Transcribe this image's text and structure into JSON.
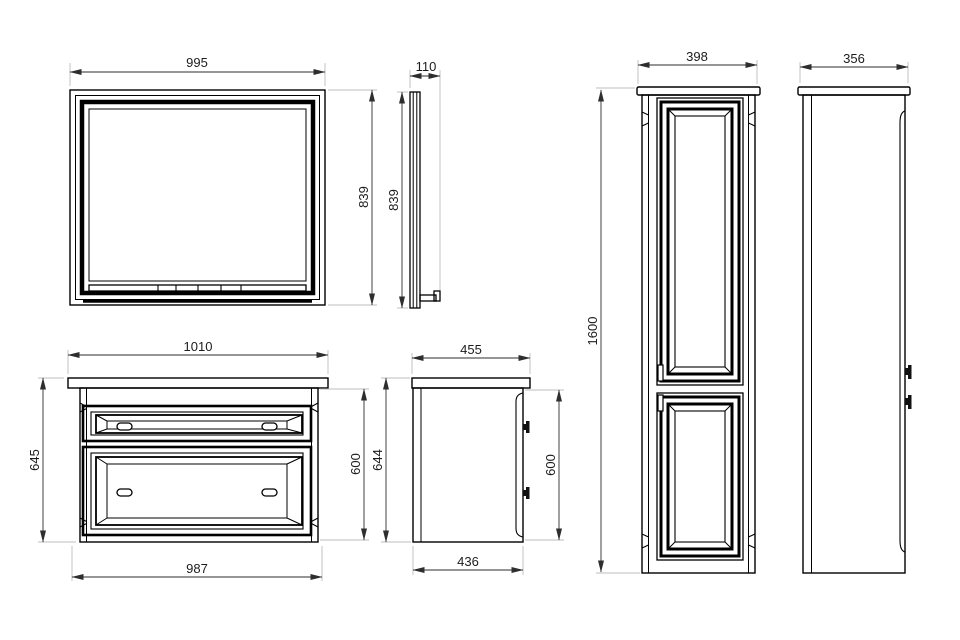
{
  "figure": {
    "type": "technical-drawing",
    "subject": "Bathroom furniture set dimension drawing: mirror (front and side view), vanity unit with two drawers (front and side view), tall cabinet with two doors (front and side view)"
  },
  "colors": {
    "background": "#ffffff",
    "outline": "#000000",
    "dimension_line": "#2e2e2e",
    "extension_line": "#bdbdbd",
    "text": "#1c1c1c"
  },
  "views": {
    "mirror_front": {
      "width": "995",
      "height": "839"
    },
    "mirror_side": {
      "depth": "110",
      "height": "839"
    },
    "vanity_front": {
      "top_width": "1010",
      "overall_height": "645",
      "carcass_height": "600",
      "bottom_width": "987"
    },
    "vanity_side": {
      "top_depth": "455",
      "overall_height": "644",
      "carcass_height": "600",
      "bottom_depth": "436"
    },
    "cabinet_front": {
      "width": "398",
      "height": "1600"
    },
    "cabinet_side": {
      "depth": "356"
    }
  }
}
